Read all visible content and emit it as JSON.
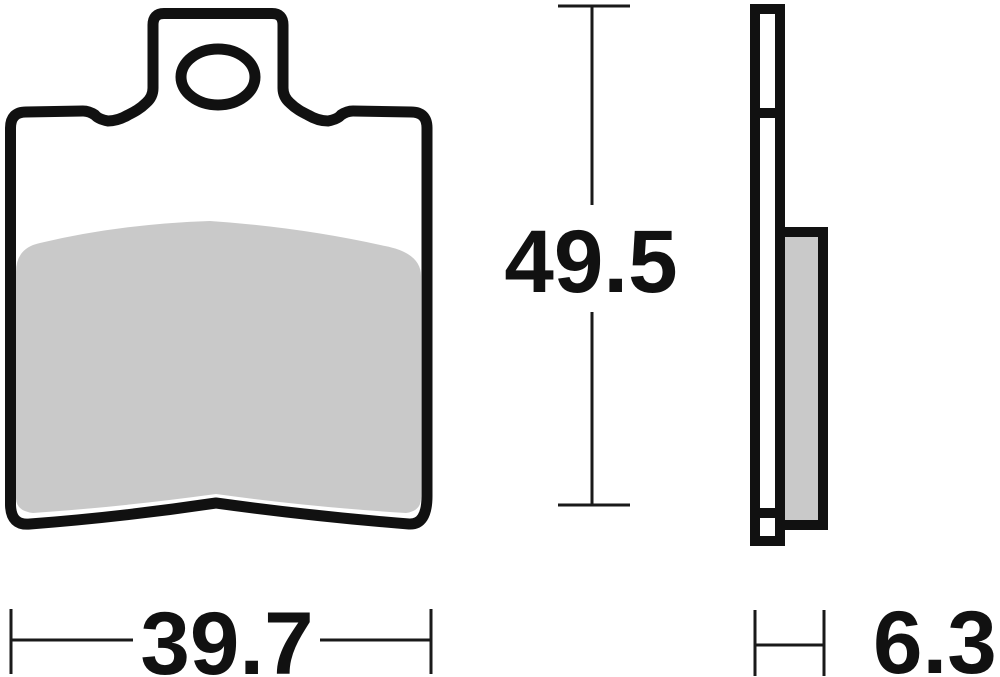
{
  "drawing": {
    "kind": "technical-drawing",
    "dimensions": {
      "height_label": "49.5",
      "width_label": "39.7",
      "thickness_label": "6.3"
    },
    "colors": {
      "outline": "#111111",
      "friction_fill": "#c9c9c9",
      "dimension_line": "#1a1a1a",
      "label_text": "#111111",
      "background": "#ffffff"
    }
  }
}
